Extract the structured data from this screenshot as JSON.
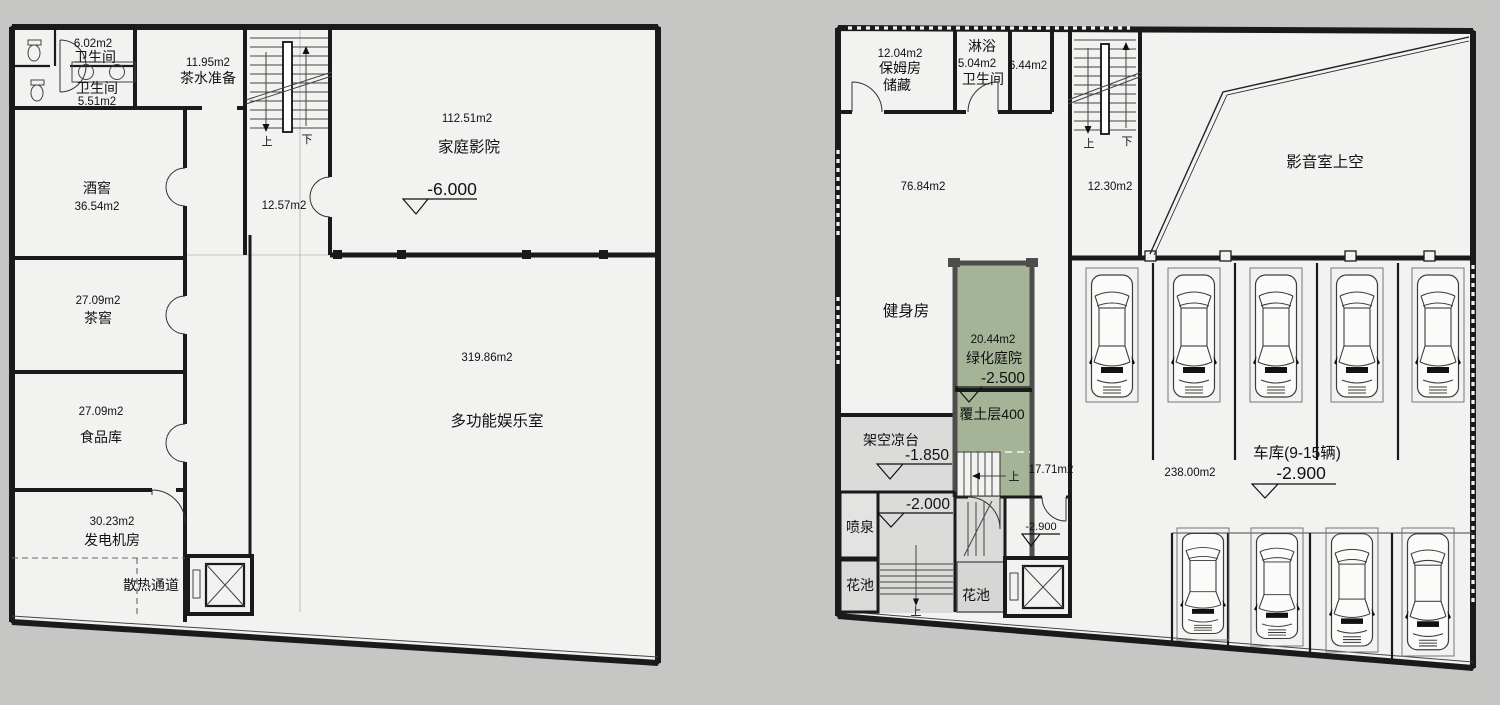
{
  "colors": {
    "background": "#c6c6c5",
    "floor": "#f2f2f1",
    "wall": "#1a1a1a",
    "courtyard_green": "#a5b396",
    "outdoor_gray": "#dbdbda"
  },
  "left": {
    "bath1": {
      "area": "6.02m2",
      "name": "卫生间"
    },
    "bath2": {
      "name": "卫生间",
      "area": "5.51m2"
    },
    "tea_prep": {
      "area": "11.95m2",
      "name": "茶水准备"
    },
    "stairs": {
      "up": "上",
      "down": "下"
    },
    "corridor": {
      "area": "12.57m2"
    },
    "home_theater": {
      "area": "112.51m2",
      "name": "家庭影院",
      "level": "-6.000"
    },
    "wine_cellar": {
      "name": "酒窖",
      "area": "36.54m2"
    },
    "tea_cellar": {
      "area": "27.09m2",
      "name": "茶窖"
    },
    "food_storage": {
      "area": "27.09m2",
      "name": "食品库"
    },
    "generator": {
      "area": "30.23m2",
      "name": "发电机房"
    },
    "heat_channel": {
      "name": "散热通道"
    },
    "rec_room": {
      "area": "319.86m2",
      "name": "多功能娱乐室"
    }
  },
  "right": {
    "nanny": {
      "area": "12.04m2",
      "name_line1": "保姆房",
      "name_line2": "储藏"
    },
    "shower": {
      "name": "淋浴",
      "area": "5.04m2"
    },
    "bath": {
      "name": "卫生间"
    },
    "room644": {
      "area": "6.44m2"
    },
    "gym": {
      "area": "76.84m2",
      "name": "健身房"
    },
    "stairs": {
      "up": "上",
      "down": "下"
    },
    "corridor": {
      "area": "12.30m2"
    },
    "av_void": {
      "name": "影音室上空"
    },
    "courtyard": {
      "area": "20.44m2",
      "name": "绿化庭院",
      "level": "-2.500",
      "note": "覆土层400"
    },
    "courtyard_stair_up": "上",
    "room1771": {
      "area": "17.71m2"
    },
    "terrace": {
      "name": "架空凉台",
      "level": "-1.850"
    },
    "level_2000": "-2.000",
    "fountain": {
      "name": "喷泉"
    },
    "flower_bed_left": {
      "name": "花池"
    },
    "flower_bed_mid": {
      "name": "花池"
    },
    "terrace_stair_up": "上",
    "level_2900_room": "-2.900",
    "garage": {
      "name": "车库(9-15辆)",
      "area": "238.00m2",
      "level": "-2.900"
    }
  }
}
